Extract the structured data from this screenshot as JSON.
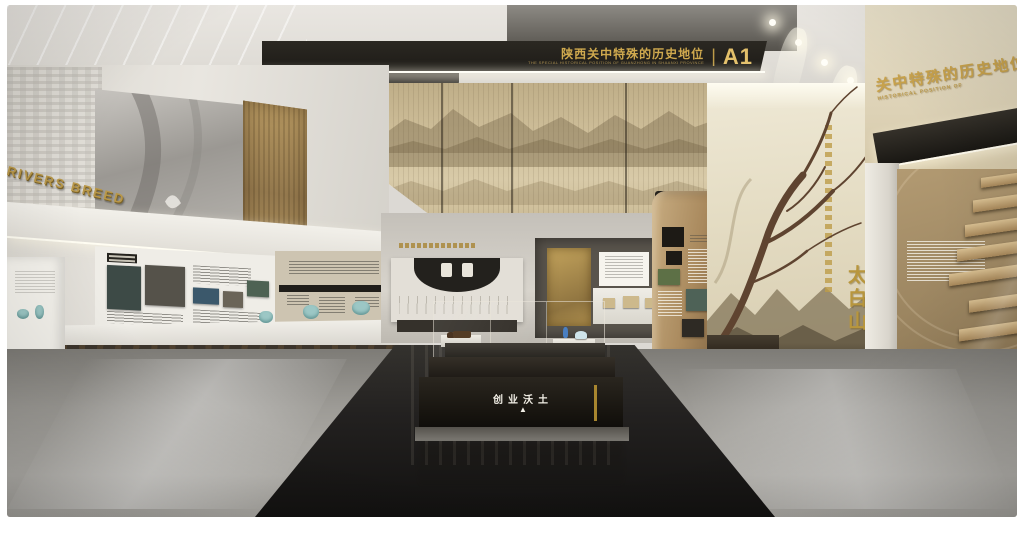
{
  "scene": {
    "description": "Museum exhibition hall interior rendering (Shaanxi Guanzhong history gallery)",
    "palette": {
      "gold_accent": "#c9a44a",
      "sign_black": "#24211c",
      "wall_white": "#eeece6",
      "scrim_tan": "#cdbd98",
      "wood_brown": "#a9895d",
      "floor_gray": "#9d9b96",
      "pool_black": "#17140f",
      "celadon": "#9cc7c5"
    }
  },
  "signs": {
    "main": {
      "zh": "陕西关中特殊的历史地位",
      "divider": "|",
      "code": "A1",
      "en": "THE SPECIAL HISTORICAL POSITION OF GUANZHONG IN SHAANXI PROVINCE"
    },
    "a2": {
      "code": "A2"
    },
    "left_wall_letters": "RIVERS BREED",
    "right_wall": {
      "calligraphy_large": "太白山"
    },
    "far_right_wall": {
      "zh": "关中特殊的历史地位",
      "en": "HISTORICAL POSITION OF"
    },
    "floor_case": {
      "text": "创业沃土",
      "arrow": "▲"
    }
  }
}
